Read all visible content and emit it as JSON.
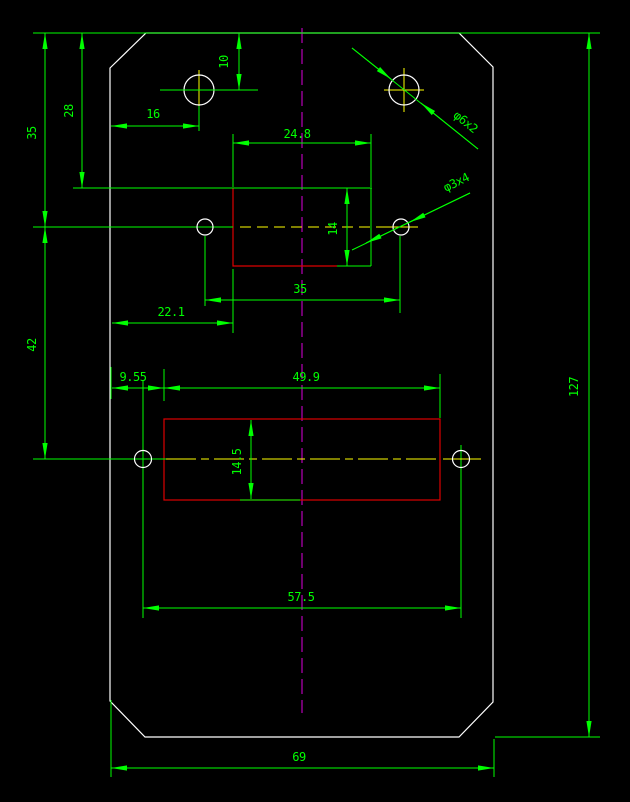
{
  "app": {
    "view": "cad-drawing-viewport"
  },
  "colors": {
    "background": "#000000",
    "outline": "#ffffff",
    "dimension": "#00ff00",
    "feature": "#dd0000",
    "centerline": "#dd00dd",
    "axis": "#ffff00"
  },
  "labels": {
    "top_to_upper_holes": "35",
    "top_to_upper_pocket": "28",
    "upper_holes_to_lower_holes": "42",
    "overall_height": "127",
    "top_to_hole_center": "10",
    "edge_to_hole_center": "16",
    "upper_pocket_width": "24.8",
    "upper_pocket_height": "14",
    "upper_holes_span": "35",
    "edge_to_upper_pocket": "22.1",
    "edge_to_lower_pocket": "9.55",
    "lower_pocket_width": "49.9",
    "lower_pocket_height": "14.5",
    "lower_holes_span": "57.5",
    "overall_width": "69",
    "top_hole_callout": "φ6x2",
    "small_hole_callout": "φ3x4"
  }
}
